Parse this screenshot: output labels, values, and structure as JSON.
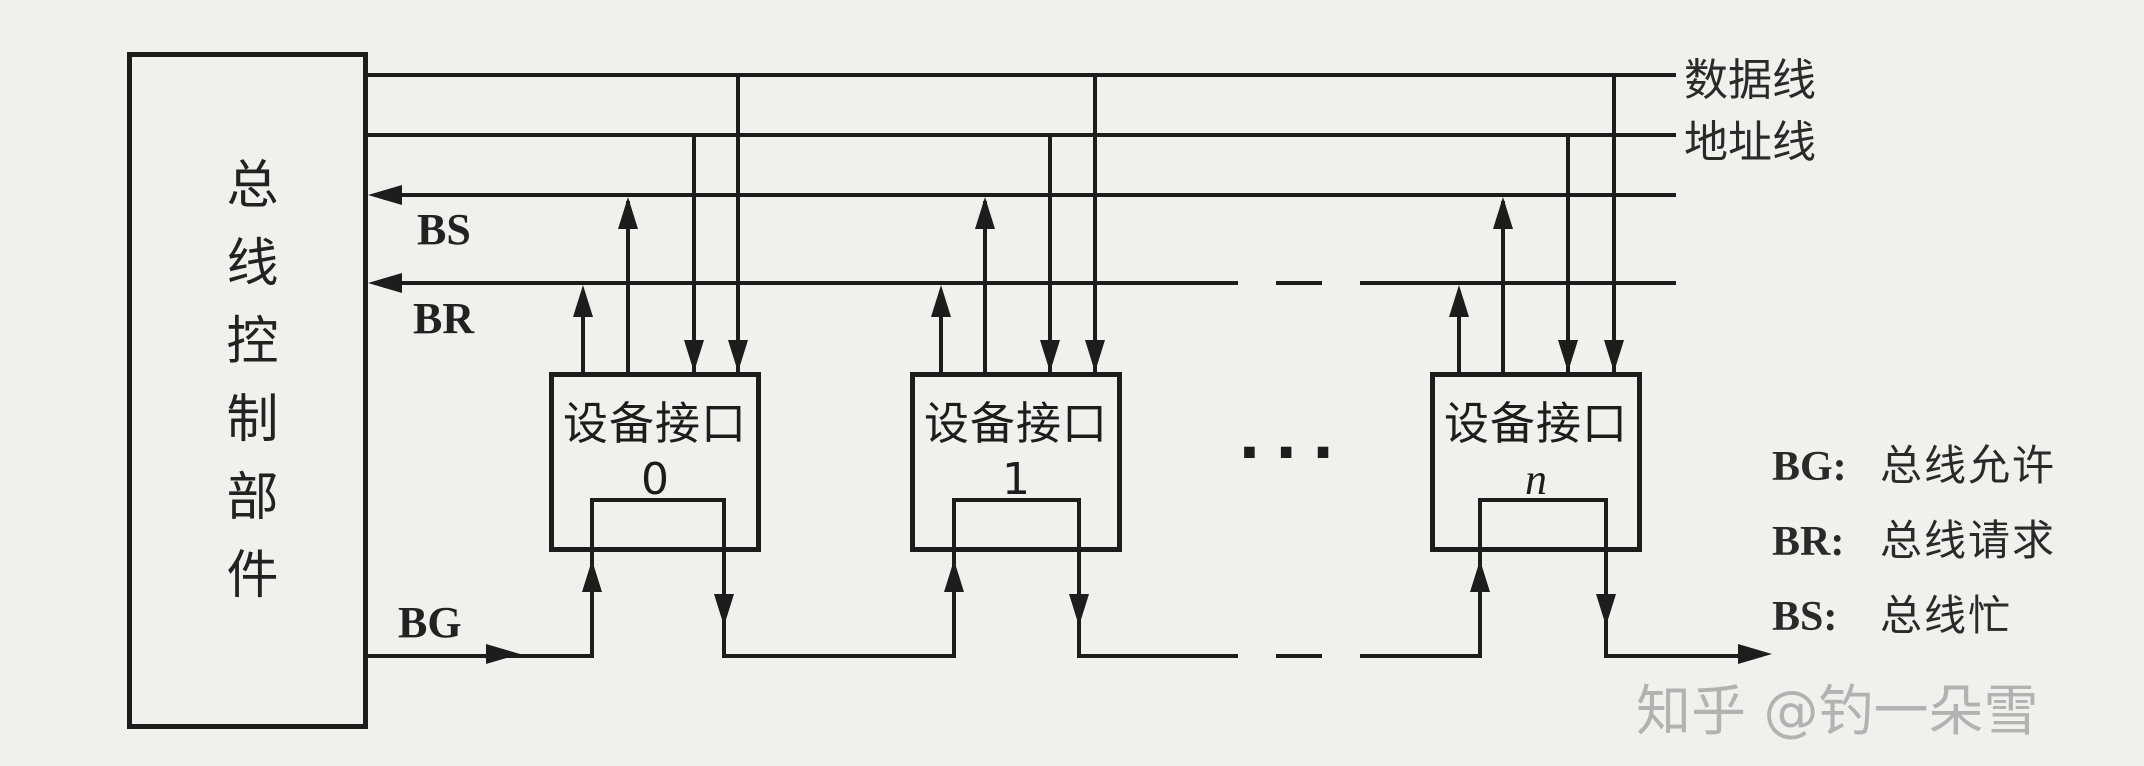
{
  "colors": {
    "background": "#f2f0ed",
    "line": "#1d1d1d",
    "watermark_gray": "#b2b2b2"
  },
  "control_unit": {
    "label": "总线控制部件"
  },
  "bus_labels": {
    "data_line": "数据线",
    "address_line": "地址线"
  },
  "signals": {
    "bs": "BS",
    "br": "BR",
    "bg": "BG"
  },
  "devices": [
    {
      "label": "设备接口",
      "index": "0"
    },
    {
      "label": "设备接口",
      "index": "1"
    },
    {
      "label": "设备接口",
      "index": "n"
    }
  ],
  "ellipsis": "···",
  "legend": [
    {
      "abbr": "BG:",
      "meaning": "总线允许"
    },
    {
      "abbr": "BR:",
      "meaning": "总线请求"
    },
    {
      "abbr": "BS:",
      "meaning": "总线忙"
    }
  ],
  "watermark": "知乎 @钓一朵雪"
}
